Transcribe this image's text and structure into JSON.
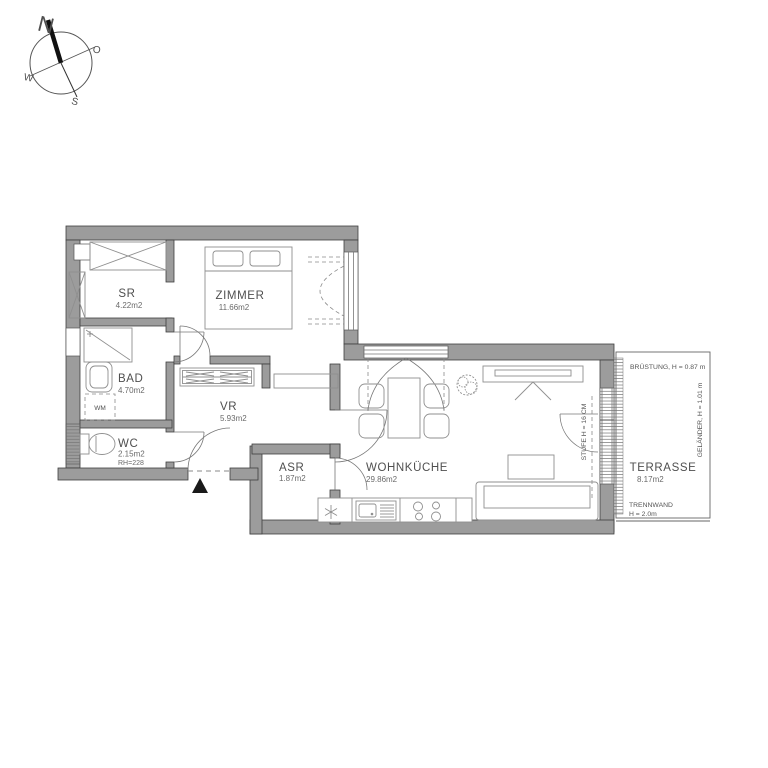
{
  "compass": {
    "north": "N",
    "east": "O",
    "south": "S",
    "west": "W"
  },
  "rooms": {
    "sr": {
      "name": "SR",
      "area": "4.22m2"
    },
    "zimmer": {
      "name": "ZIMMER",
      "area": "11.66m2"
    },
    "bad": {
      "name": "BAD",
      "area": "4.70m2"
    },
    "wc": {
      "name": "WC",
      "area": "2.15m2",
      "room_height": "RH=228"
    },
    "vr": {
      "name": "VR",
      "area": "5.93m2"
    },
    "asr": {
      "name": "ASR",
      "area": "1.87m2"
    },
    "wohnkueche": {
      "name": "WOHNKÜCHE",
      "area": "29.86m2"
    },
    "terrasse": {
      "name": "TERRASSE",
      "area": "8.17m2"
    }
  },
  "annotations": {
    "bruestung": "BRÜSTUNG, H = 0.87 m",
    "gelaender": "GELÄNDER, H = 1.01 m",
    "trennwand_1": "TRENNWAND",
    "trennwand_2": "H = 2.0m",
    "stufe": "STUFE H = 16 CM",
    "wm": "WM"
  },
  "colors": {
    "wall": "#9c9c9c",
    "wall_outline": "#3f3f3f",
    "text": "#4f4f4f"
  }
}
